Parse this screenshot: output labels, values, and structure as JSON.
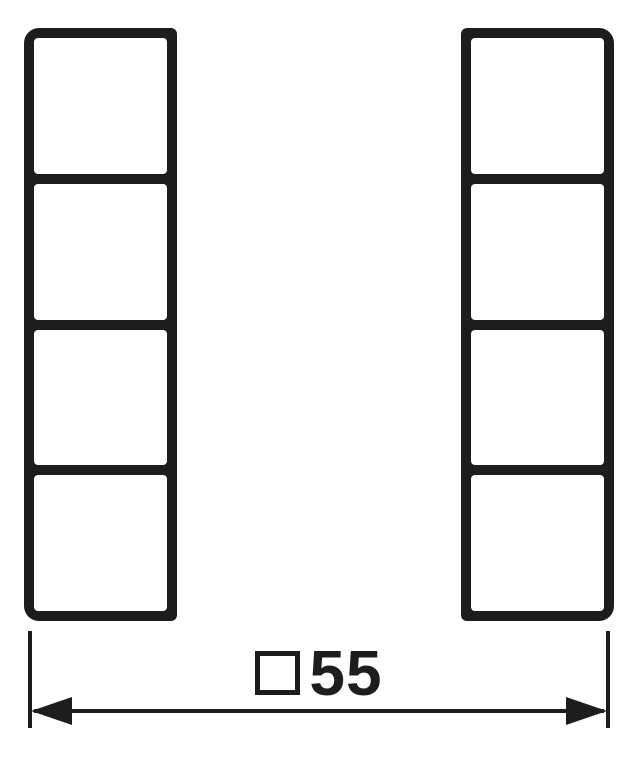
{
  "diagram": {
    "kind": "technical-dimension-drawing",
    "ink_color": "#1d1d1b",
    "background_color": "#ffffff",
    "columns": [
      {
        "name": "left-button-column",
        "cells": 4
      },
      {
        "name": "right-button-column",
        "cells": 4
      }
    ],
    "dimension": {
      "symbol_icon": "square-symbol",
      "value": "55",
      "full_label": "□55"
    }
  }
}
